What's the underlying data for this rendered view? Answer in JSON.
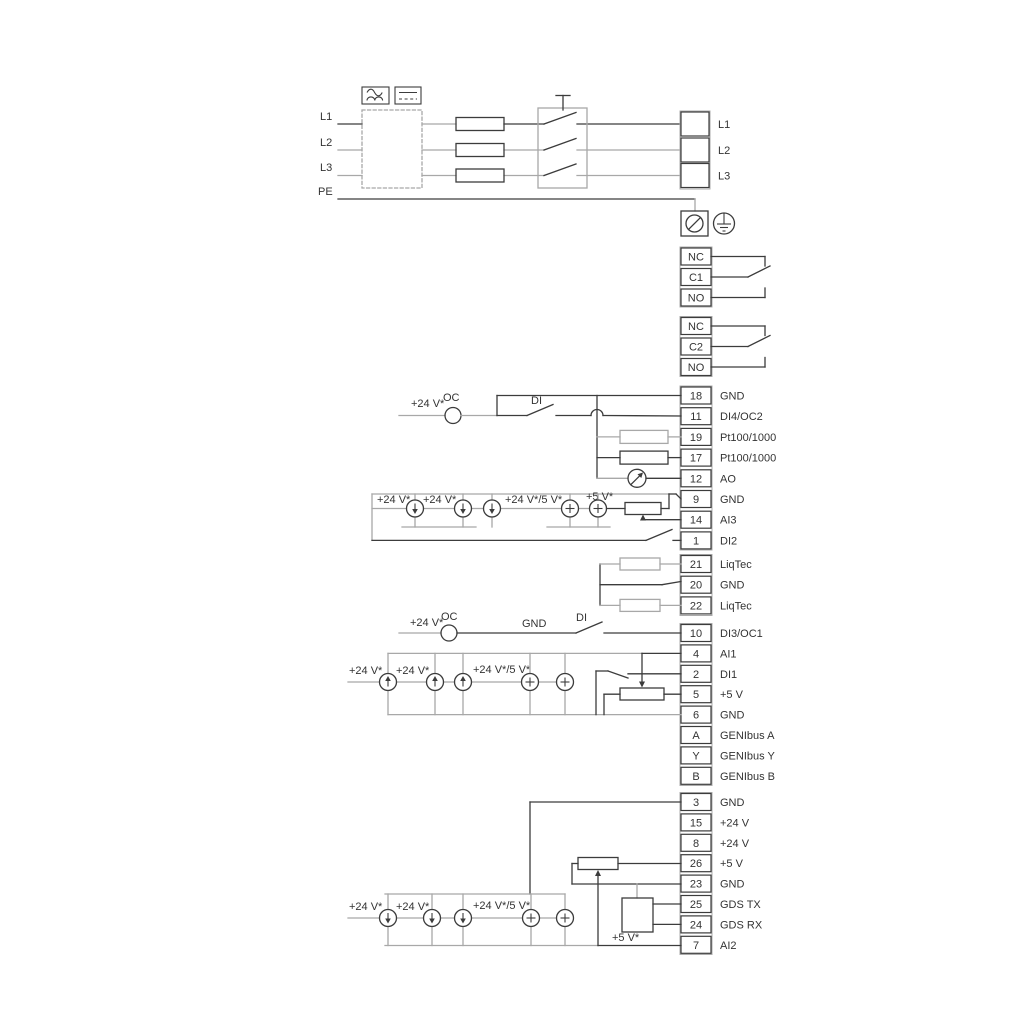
{
  "colors": {
    "line_dark": "#3c3c3c",
    "line_grey": "#a8a8a8",
    "text": "#333333",
    "background": "#ffffff"
  },
  "power": {
    "inputs": [
      "L1",
      "L2",
      "L3",
      "PE"
    ],
    "outputs": [
      "L1",
      "L2",
      "L3"
    ]
  },
  "relays": {
    "r1": [
      "NC",
      "C1",
      "NO"
    ],
    "r2": [
      "NC",
      "C2",
      "NO"
    ]
  },
  "labels": {
    "plus24": "+24 V*",
    "plus24or5": "+24 V*/5 V*",
    "plus5": "+5 V*",
    "oc": "OC",
    "di": "DI",
    "gnd": "GND"
  },
  "blocks": {
    "io1": {
      "rows": [
        {
          "num": "18",
          "label": "GND"
        },
        {
          "num": "11",
          "label": "DI4/OC2"
        },
        {
          "num": "19",
          "label": "Pt100/1000"
        },
        {
          "num": "17",
          "label": "Pt100/1000"
        },
        {
          "num": "12",
          "label": "AO"
        },
        {
          "num": "9",
          "label": "GND"
        },
        {
          "num": "14",
          "label": "AI3"
        },
        {
          "num": "1",
          "label": "DI2"
        }
      ]
    },
    "liqtec": {
      "rows": [
        {
          "num": "21",
          "label": "LiqTec"
        },
        {
          "num": "20",
          "label": "GND"
        },
        {
          "num": "22",
          "label": "LiqTec"
        }
      ]
    },
    "io2": {
      "rows": [
        {
          "num": "10",
          "label": "DI3/OC1"
        },
        {
          "num": "4",
          "label": "AI1"
        },
        {
          "num": "2",
          "label": "DI1"
        },
        {
          "num": "5",
          "label": "+5 V"
        },
        {
          "num": "6",
          "label": "GND"
        },
        {
          "num": "A",
          "label": "GENIbus A"
        },
        {
          "num": "Y",
          "label": "GENIbus Y"
        },
        {
          "num": "B",
          "label": "GENIbus B"
        }
      ]
    },
    "io3": {
      "rows": [
        {
          "num": "3",
          "label": "GND"
        },
        {
          "num": "15",
          "label": "+24 V"
        },
        {
          "num": "8",
          "label": "+24 V"
        },
        {
          "num": "26",
          "label": "+5 V"
        },
        {
          "num": "23",
          "label": "GND"
        },
        {
          "num": "25",
          "label": "GDS TX"
        },
        {
          "num": "24",
          "label": "GDS RX"
        },
        {
          "num": "7",
          "label": "AI2"
        }
      ]
    }
  }
}
